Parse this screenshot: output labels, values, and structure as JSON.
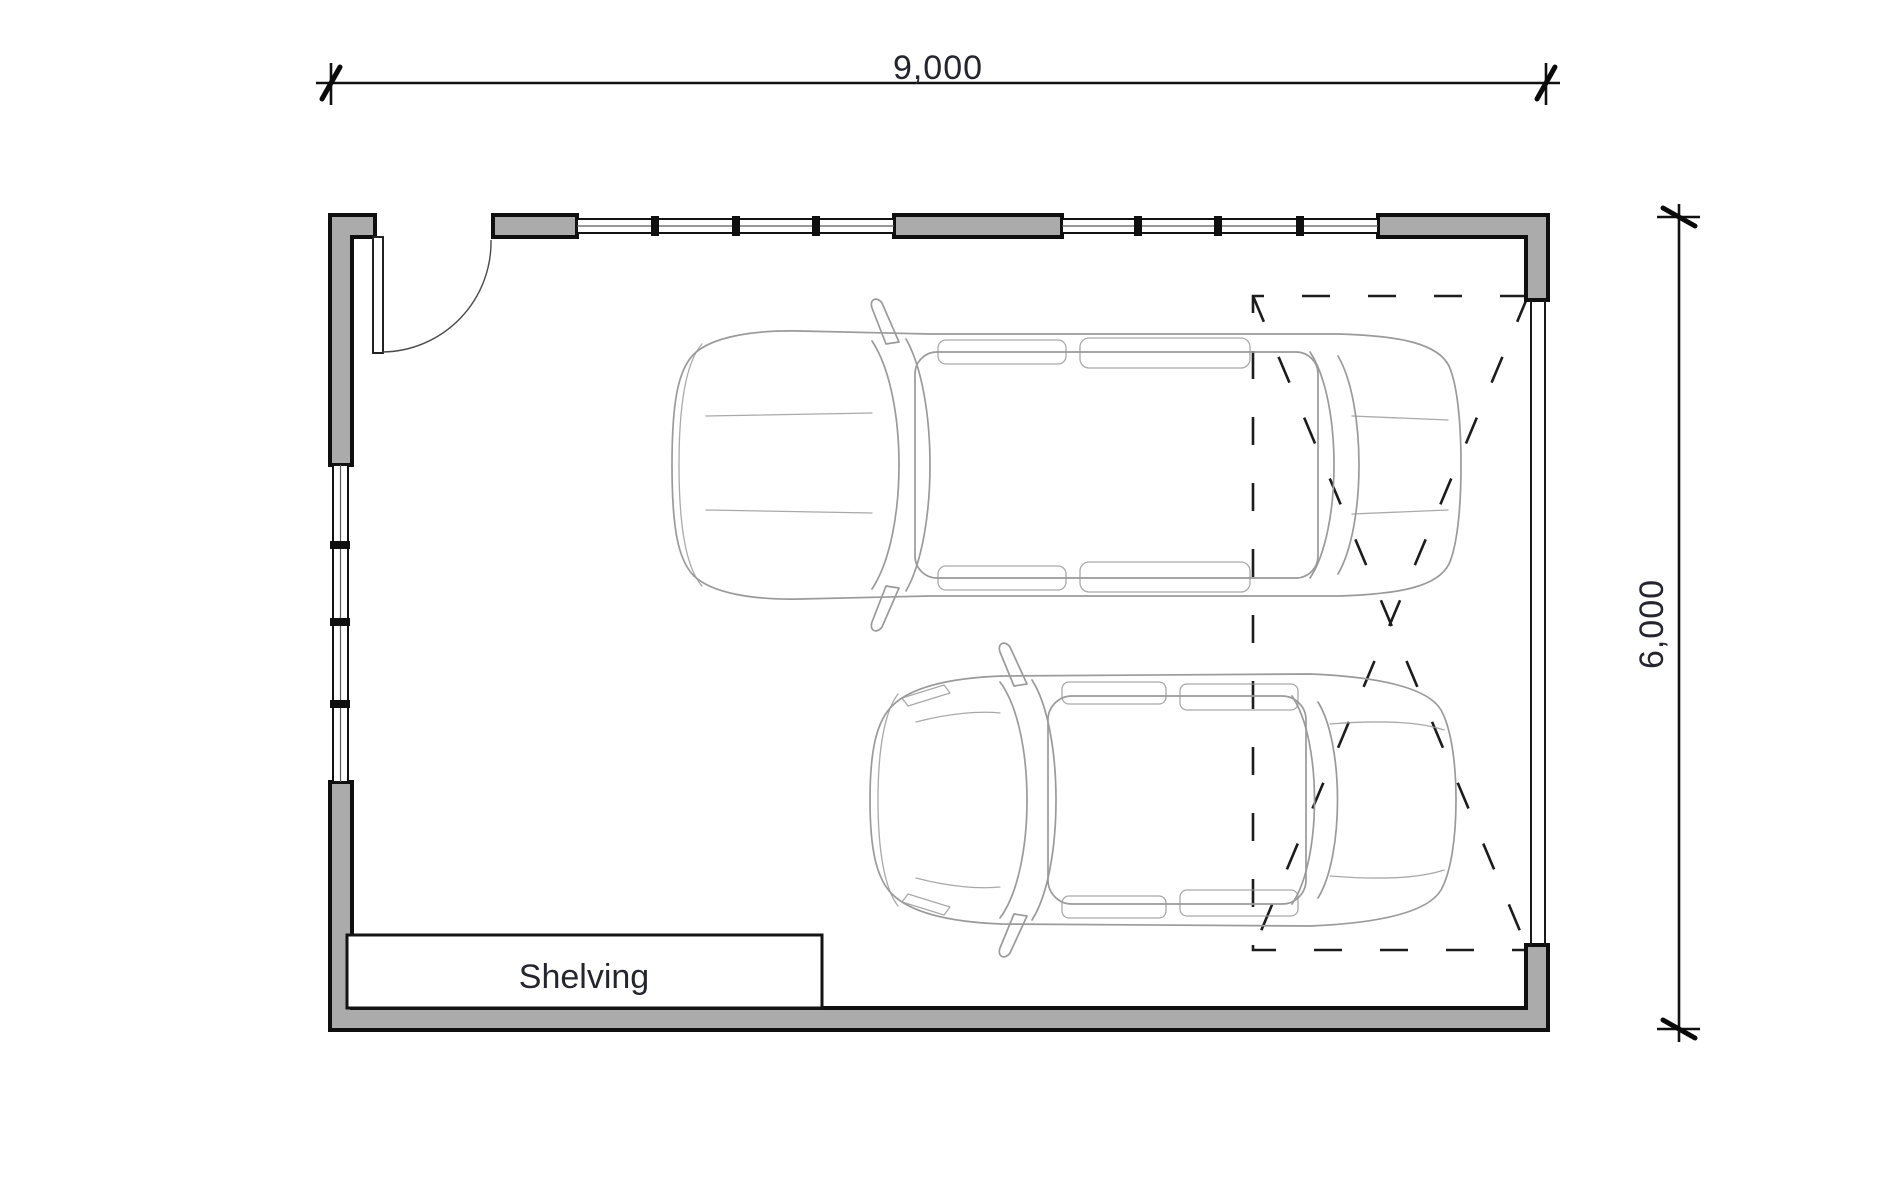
{
  "dimensions": {
    "width_label": "9,000",
    "height_label": "6,000"
  },
  "labels": {
    "shelving": "Shelving"
  },
  "colors": {
    "background": "#ffffff",
    "wall_fill": "#ababab",
    "wall_outline": "#0f0f0f",
    "dimension_text": "#25252d",
    "car_outline": "#9a9a9a",
    "dashed_garage_door": "#1c1c1c"
  },
  "features": {
    "entry_doors": 1,
    "window_strips": 3,
    "cars": 2,
    "garage_door_dashed_outline": 1,
    "shelving_units": 1
  }
}
